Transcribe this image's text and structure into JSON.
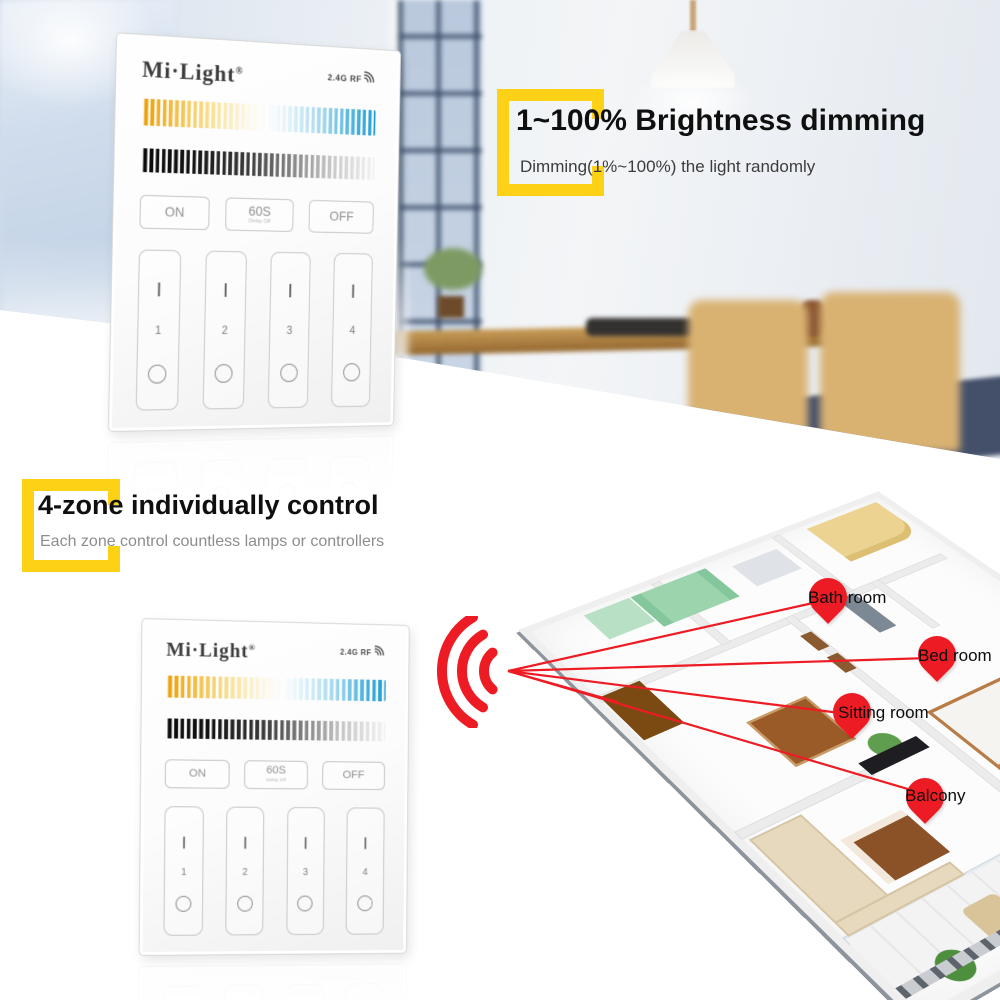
{
  "section_brightness": {
    "title": "1~100% Brightness dimming",
    "subtitle": "Dimming(1%~100%) the light randomly"
  },
  "section_zones": {
    "title": "4-zone individually control",
    "subtitle": "Each zone control countless lamps or controllers"
  },
  "panel": {
    "brand": "Mi·Light",
    "registered_mark": "®",
    "rf_label": "2.4G RF",
    "rf_icon": "rf-signal-icon",
    "buttons": [
      {
        "label": "ON"
      },
      {
        "label": "60S",
        "sublabel": "Delay Off"
      },
      {
        "label": "OFF"
      }
    ],
    "zones": [
      "1",
      "2",
      "3",
      "4"
    ],
    "zone_top_glyph": "|",
    "zone_bottom_icon": "circle-outline"
  },
  "floorplan": {
    "wifi_icon": "wifi-signal-icon",
    "pins": [
      {
        "label": "Bath room"
      },
      {
        "label": "Bed room"
      },
      {
        "label": "Sitting room"
      },
      {
        "label": "Balcony"
      }
    ]
  },
  "colors": {
    "accent_yellow": "#FDD116",
    "accent_red": "#ED1C24",
    "cct_warm": "#EE9D00",
    "cct_cool": "#1F9CD6",
    "brightness_dark": "#0B0B0B"
  }
}
